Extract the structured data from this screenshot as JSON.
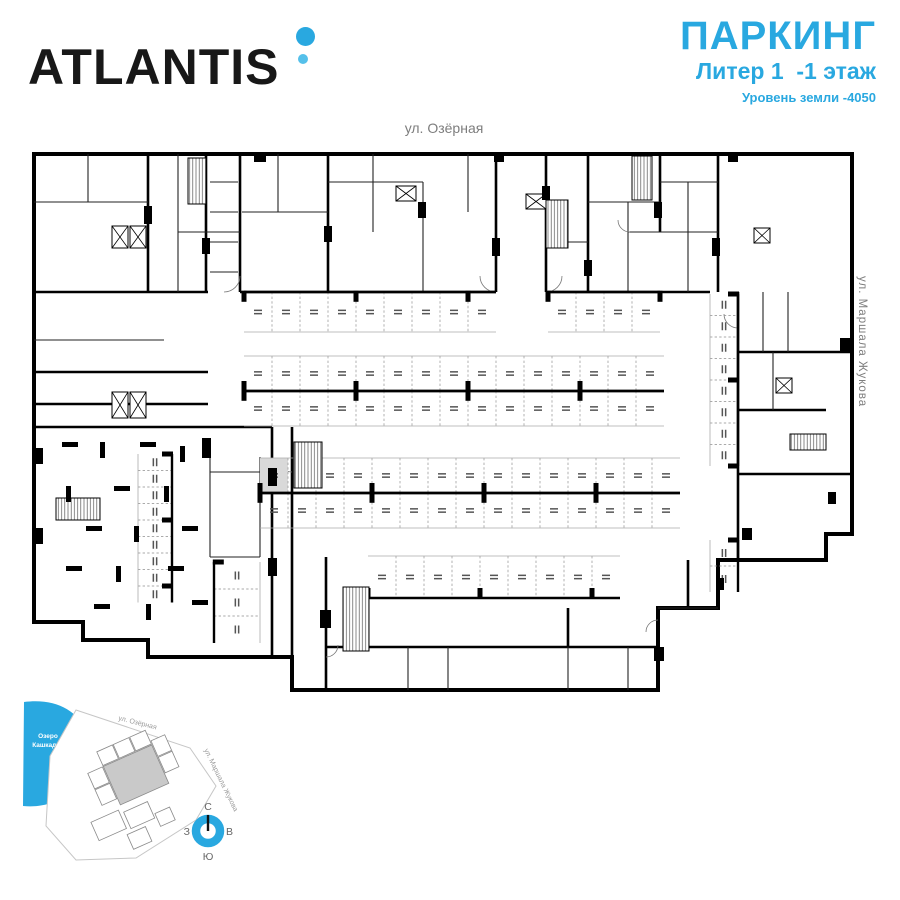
{
  "brand": {
    "logo_text": "ATLANTIS",
    "dot_color_big": "#29a8e0",
    "dot_color_small": "#55c0ea"
  },
  "title": {
    "heading": "ПАРКИНГ",
    "subheading": "Литер 1  -1 этаж",
    "level_note": "Уровень земли -4050",
    "accent_color": "#29a8e0"
  },
  "streets": {
    "top": "ул. Озёрная",
    "right": "ул. Маршала Жукова"
  },
  "minimap": {
    "lake_label_line1": "Озеро",
    "lake_label_line2": "Кашкадан",
    "street_top": "ул. Озёрная",
    "street_right": "ул. Маршала Жукова",
    "compass": {
      "north": "С",
      "south": "Ю",
      "west": "З",
      "east": "В",
      "ring_color": "#29a8e0"
    },
    "lake_color": "#29a8e0",
    "highlight_building_color": "#c9c9c9"
  },
  "plan": {
    "wall_color": "#000000",
    "highlight_stall_color": "#d9d9d9",
    "parking_rows": [
      {
        "x": 216,
        "y": 150,
        "w": 28,
        "h": 40,
        "count": 9,
        "orient": "h",
        "closed": "top"
      },
      {
        "x": 520,
        "y": 150,
        "w": 28,
        "h": 40,
        "count": 4,
        "orient": "h",
        "closed": "top"
      },
      {
        "x": 216,
        "y": 214,
        "w": 28,
        "h": 35,
        "count": 15,
        "orient": "h",
        "closed": "bottom"
      },
      {
        "x": 216,
        "y": 249,
        "w": 28,
        "h": 35,
        "count": 15,
        "orient": "h",
        "closed": "top"
      },
      {
        "x": 232,
        "y": 316,
        "w": 28,
        "h": 35,
        "count": 15,
        "orient": "h",
        "closed": "bottom",
        "gray": 0
      },
      {
        "x": 232,
        "y": 351,
        "w": 28,
        "h": 35,
        "count": 15,
        "orient": "h",
        "closed": "top"
      },
      {
        "x": 340,
        "y": 414,
        "w": 28,
        "h": 42,
        "count": 9,
        "orient": "h",
        "closed": "bottom"
      },
      {
        "x": 110,
        "y": 312,
        "w": 34,
        "h": 16.5,
        "count": 9,
        "orient": "v",
        "closed": "right"
      },
      {
        "x": 682,
        "y": 152,
        "w": 28,
        "h": 21.5,
        "count": 8,
        "orient": "v",
        "closed": "right"
      },
      {
        "x": 682,
        "y": 398,
        "w": 28,
        "h": 26,
        "count": 2,
        "orient": "v",
        "closed": "right"
      },
      {
        "x": 186,
        "y": 420,
        "w": 46,
        "h": 27,
        "count": 3,
        "orient": "v",
        "closed": "left"
      }
    ],
    "elevators": [
      [
        84,
        84,
        16,
        22
      ],
      [
        102,
        84,
        16,
        22
      ],
      [
        368,
        44,
        20,
        15
      ],
      [
        498,
        52,
        20,
        15
      ],
      [
        726,
        86,
        16,
        15
      ],
      [
        84,
        250,
        16,
        26
      ],
      [
        102,
        250,
        16,
        26
      ],
      [
        748,
        236,
        16,
        15
      ]
    ],
    "stairs": [
      [
        160,
        16,
        18,
        46
      ],
      [
        518,
        58,
        22,
        48
      ],
      [
        604,
        14,
        20,
        44
      ],
      [
        266,
        300,
        28,
        46
      ],
      [
        315,
        445,
        26,
        64
      ],
      [
        28,
        356,
        44,
        22
      ],
      [
        762,
        292,
        36,
        16
      ]
    ],
    "columns": [
      [
        34,
        300,
        16,
        5
      ],
      [
        72,
        300,
        5,
        16
      ],
      [
        112,
        300,
        16,
        5
      ],
      [
        152,
        304,
        5,
        16
      ],
      [
        38,
        344,
        5,
        16
      ],
      [
        86,
        344,
        16,
        5
      ],
      [
        136,
        344,
        5,
        16
      ],
      [
        58,
        384,
        16,
        5
      ],
      [
        106,
        384,
        5,
        16
      ],
      [
        154,
        384,
        16,
        5
      ],
      [
        38,
        424,
        16,
        5
      ],
      [
        88,
        424,
        5,
        16
      ],
      [
        140,
        424,
        16,
        5
      ],
      [
        66,
        462,
        16,
        5
      ],
      [
        118,
        462,
        5,
        16
      ],
      [
        164,
        458,
        16,
        5
      ]
    ],
    "wall_blocks": [
      [
        116,
        64,
        8,
        18
      ],
      [
        174,
        96,
        8,
        16
      ],
      [
        226,
        12,
        12,
        8
      ],
      [
        296,
        84,
        8,
        16
      ],
      [
        390,
        60,
        8,
        16
      ],
      [
        464,
        96,
        8,
        18
      ],
      [
        514,
        44,
        8,
        14
      ],
      [
        556,
        118,
        8,
        16
      ],
      [
        626,
        60,
        8,
        16
      ],
      [
        684,
        96,
        8,
        18
      ],
      [
        6,
        306,
        9,
        16
      ],
      [
        6,
        386,
        9,
        16
      ],
      [
        174,
        296,
        9,
        20
      ],
      [
        240,
        326,
        9,
        18
      ],
      [
        240,
        416,
        9,
        18
      ],
      [
        292,
        468,
        11,
        18
      ],
      [
        626,
        505,
        10,
        14
      ],
      [
        688,
        436,
        8,
        12
      ],
      [
        812,
        196,
        10,
        14
      ],
      [
        714,
        386,
        10,
        12
      ],
      [
        800,
        350,
        8,
        12
      ],
      [
        466,
        12,
        10,
        8
      ],
      [
        700,
        12,
        10,
        8
      ]
    ]
  }
}
